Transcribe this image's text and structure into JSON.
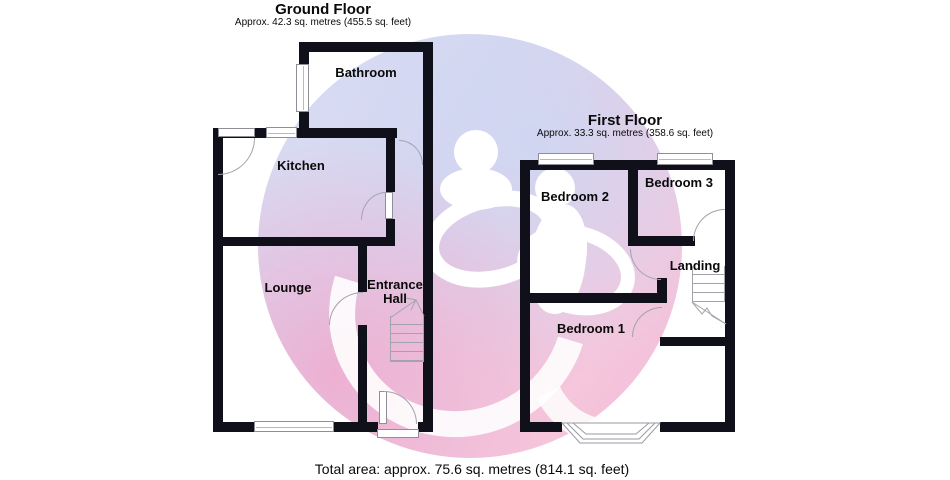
{
  "ground_floor": {
    "title": "Ground Floor",
    "subtitle": "Approx. 42.3 sq. metres (455.5 sq. feet)",
    "rooms": [
      {
        "name": "Bathroom"
      },
      {
        "name": "Kitchen"
      },
      {
        "name": "Lounge"
      },
      {
        "name": "Entrance Hall"
      }
    ]
  },
  "first_floor": {
    "title": "First Floor",
    "subtitle": "Approx. 33.3 sq. metres (358.6 sq. feet)",
    "rooms": [
      {
        "name": "Bedroom 2"
      },
      {
        "name": "Bedroom 3"
      },
      {
        "name": "Landing"
      },
      {
        "name": "Bedroom 1"
      }
    ]
  },
  "footer": {
    "total_area": "Total area: approx. 75.6 sq. metres (814.1 sq. feet)"
  },
  "colors": {
    "wall": "#10101a",
    "outline_grey": "#9a9aa2",
    "watermark_pink": "#f5c6dc",
    "watermark_blue": "#d6ddf3"
  }
}
